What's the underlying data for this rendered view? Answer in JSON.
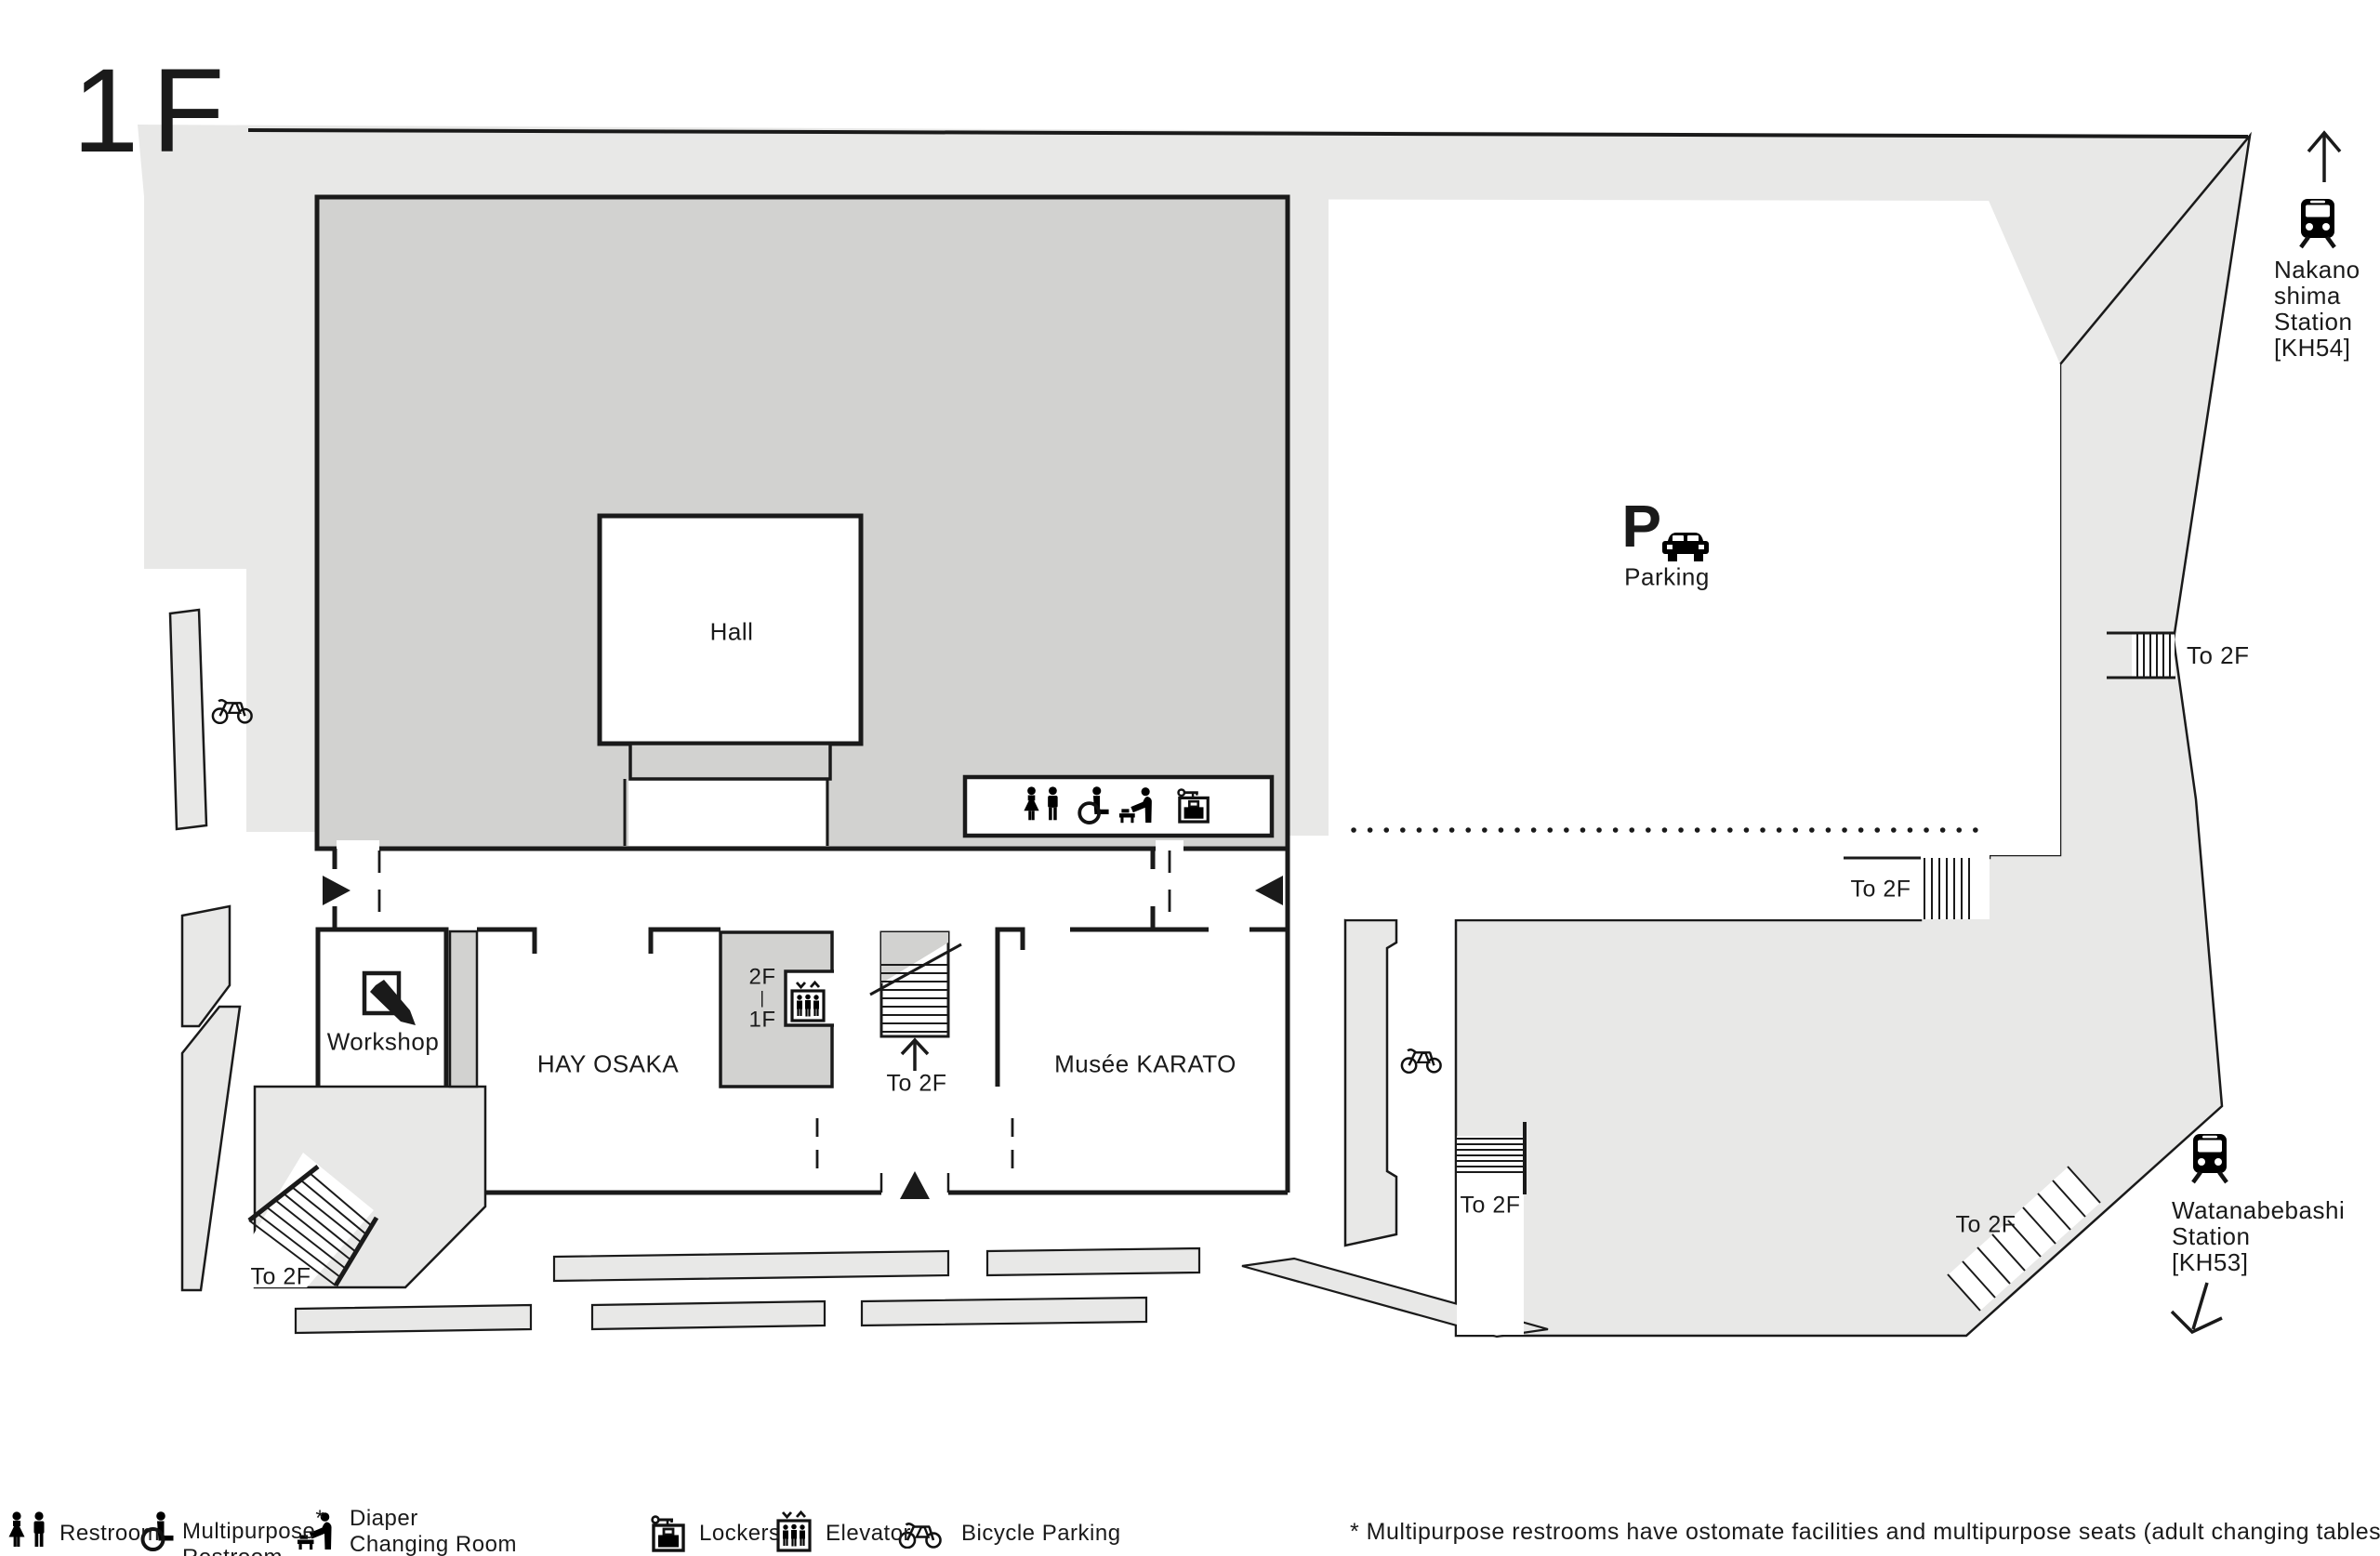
{
  "floor_label": "1F",
  "colors": {
    "area_light": "#e8e8e7",
    "area_dark": "#d2d2d0",
    "line": "#1a1a1a",
    "background": "#ffffff"
  },
  "map": {
    "hall": "Hall",
    "parking": "Parking",
    "parking_p": "P",
    "workshop": "Workshop",
    "hay_osaka": "HAY OSAKA",
    "musee_karato": "Musée KARATO",
    "to_2f": "To 2F",
    "elevator_floors": [
      "2F",
      "|",
      "1F"
    ],
    "stations": {
      "nakanoshima": [
        "Nakano",
        "shima",
        "Station",
        "[KH54]"
      ],
      "watanabebashi": [
        "Watanabebashi",
        "Station",
        "[KH53]"
      ]
    }
  },
  "legend": {
    "restroom": "Restroom",
    "multipurpose_line1": "Multipurpose",
    "multipurpose_asterisk": "*",
    "multipurpose_line2": "Restroom",
    "diaper_line1": "Diaper",
    "diaper_line2": "Changing Room",
    "lockers": "Lockers",
    "elevator": "Elevator",
    "bicycle_parking": "Bicycle Parking",
    "note": "* Multipurpose restrooms have ostomate facilities and multipurpose seats (adult changing tables)."
  }
}
